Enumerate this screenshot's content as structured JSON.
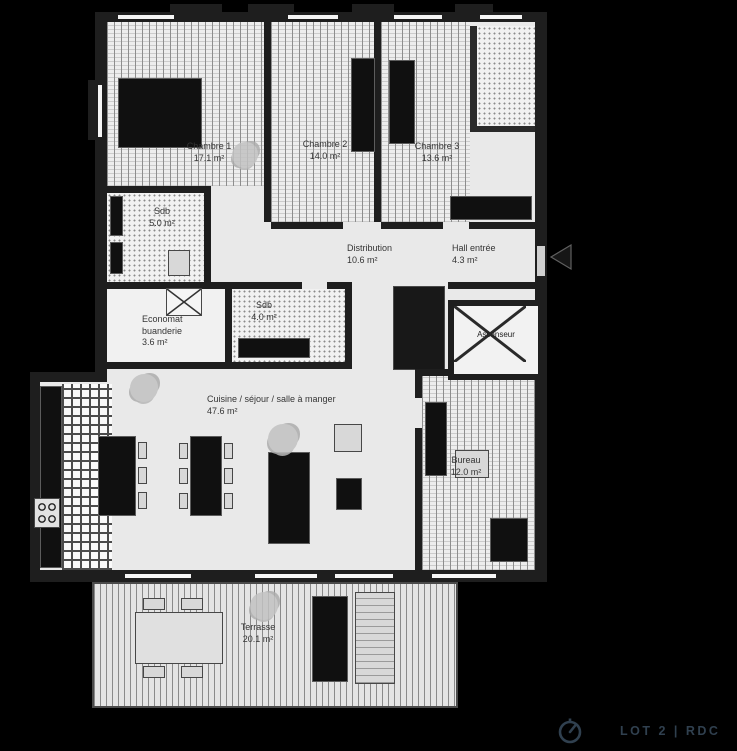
{
  "plan": {
    "rooms": [
      {
        "id": "chambre-1",
        "name": "Chambre 1",
        "area": "17.1 m²"
      },
      {
        "id": "chambre-2",
        "name": "Chambre 2",
        "area": "14.0 m²"
      },
      {
        "id": "chambre-3",
        "name": "Chambre 3",
        "area": "13.6 m²"
      },
      {
        "id": "sdb-1",
        "name": "Sdb",
        "area": "5.0 m²"
      },
      {
        "id": "distribution",
        "name": "Distribution",
        "area": "10.6 m²"
      },
      {
        "id": "hall-entree",
        "name": "Hall entrée",
        "area": "4.3 m²"
      },
      {
        "id": "economat-buanderie",
        "name": "Economat buanderie",
        "area": "3.6 m²"
      },
      {
        "id": "sdb-2",
        "name": "Sdb",
        "area": "4.0 m²"
      },
      {
        "id": "cuisine-sejour",
        "name": "Cuisine / séjour / salle à manger",
        "area": "47.6 m²"
      },
      {
        "id": "bureau",
        "name": "Bureau",
        "area": "12.0 m²"
      },
      {
        "id": "terrasse",
        "name": "Terrasse",
        "area": "20.1 m²"
      }
    ],
    "elevator_label": "Ascenseur"
  },
  "footer": {
    "lot_label": "LOT 2 | RDC"
  },
  "colors": {
    "accent": "#30404f",
    "wall": "#1e1e1e",
    "floor": "#e9e9e9",
    "background": "#000000"
  },
  "icons": {
    "orientation": "north-compass-icon",
    "entrance": "entrance-arrow-icon"
  }
}
